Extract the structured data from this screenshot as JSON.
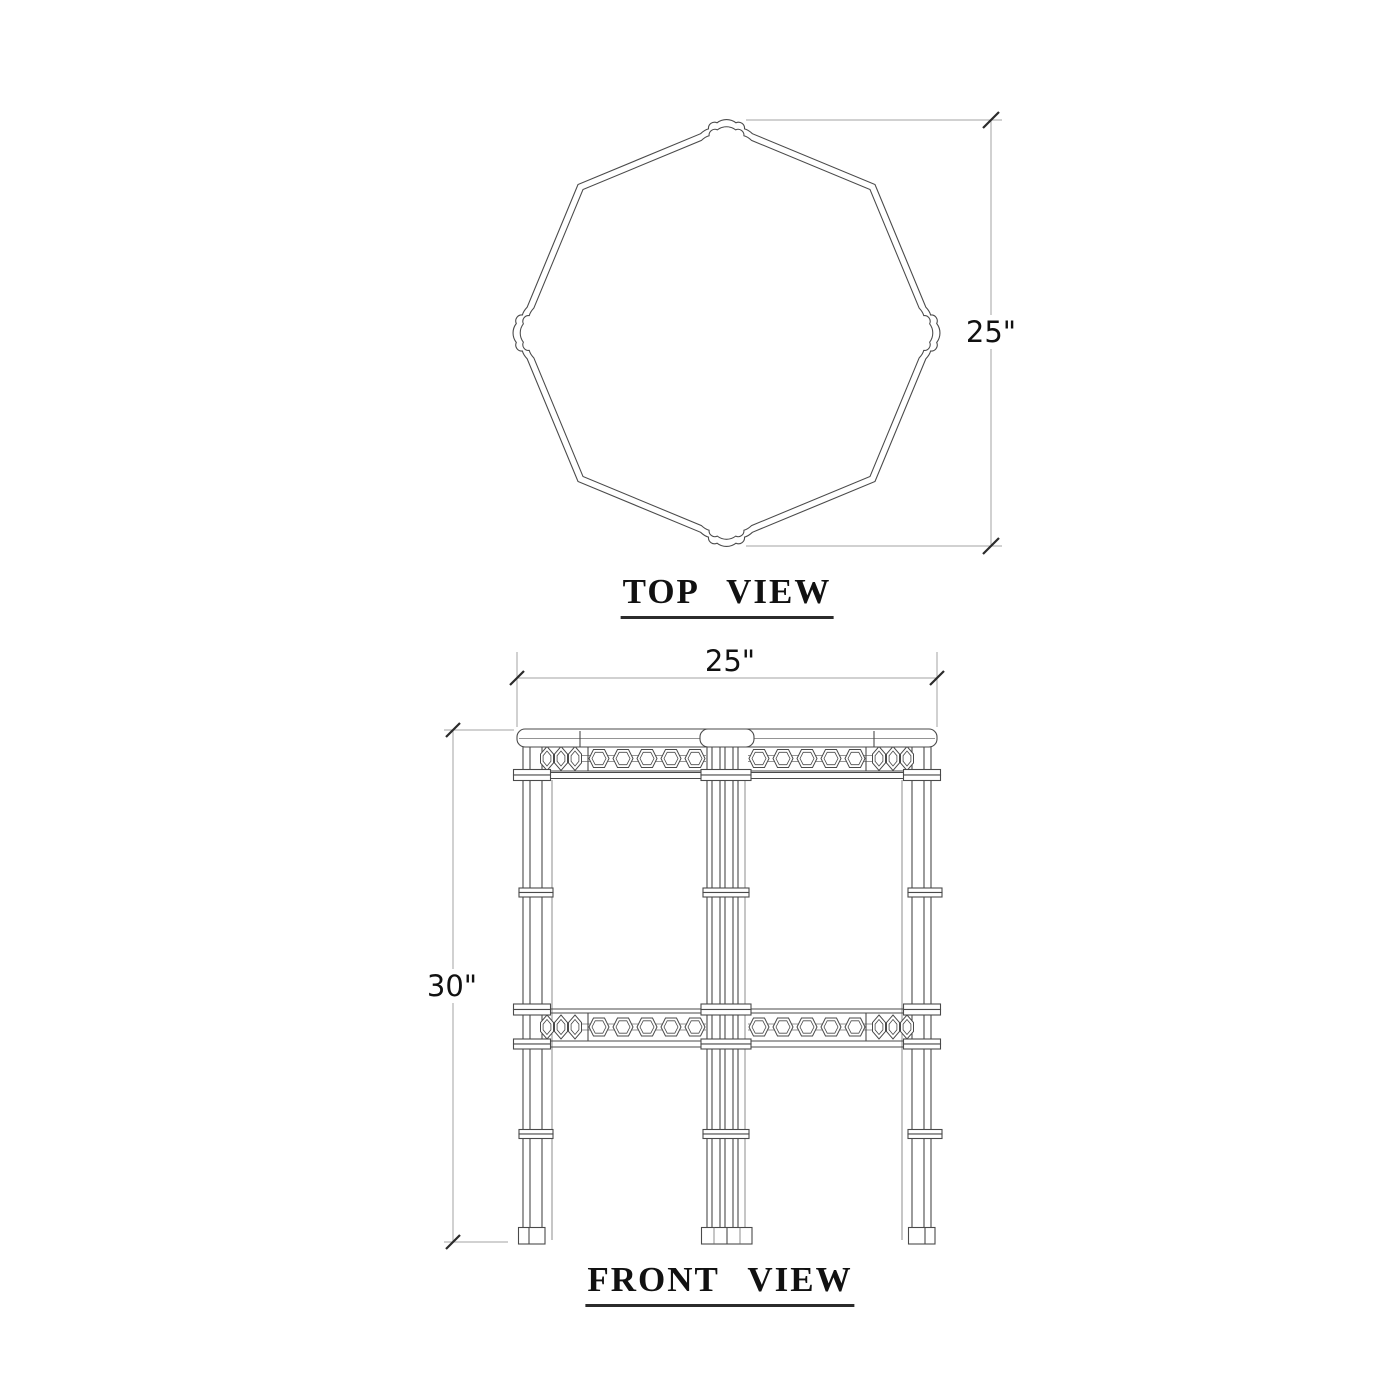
{
  "document": {
    "kind": "furniture dimension drawing",
    "subject": "octagonal two-tier fretwork side table",
    "background_color": "#ffffff",
    "line_color": "#4a4a4a",
    "dimension_line_color": "#a3a3a3",
    "text_color": "#111111"
  },
  "views": {
    "top": {
      "title": "TOP  VIEW",
      "dimension_height": "25\""
    },
    "front": {
      "title": "FRONT  VIEW",
      "dimension_width": "25\"",
      "dimension_height": "30\""
    }
  }
}
